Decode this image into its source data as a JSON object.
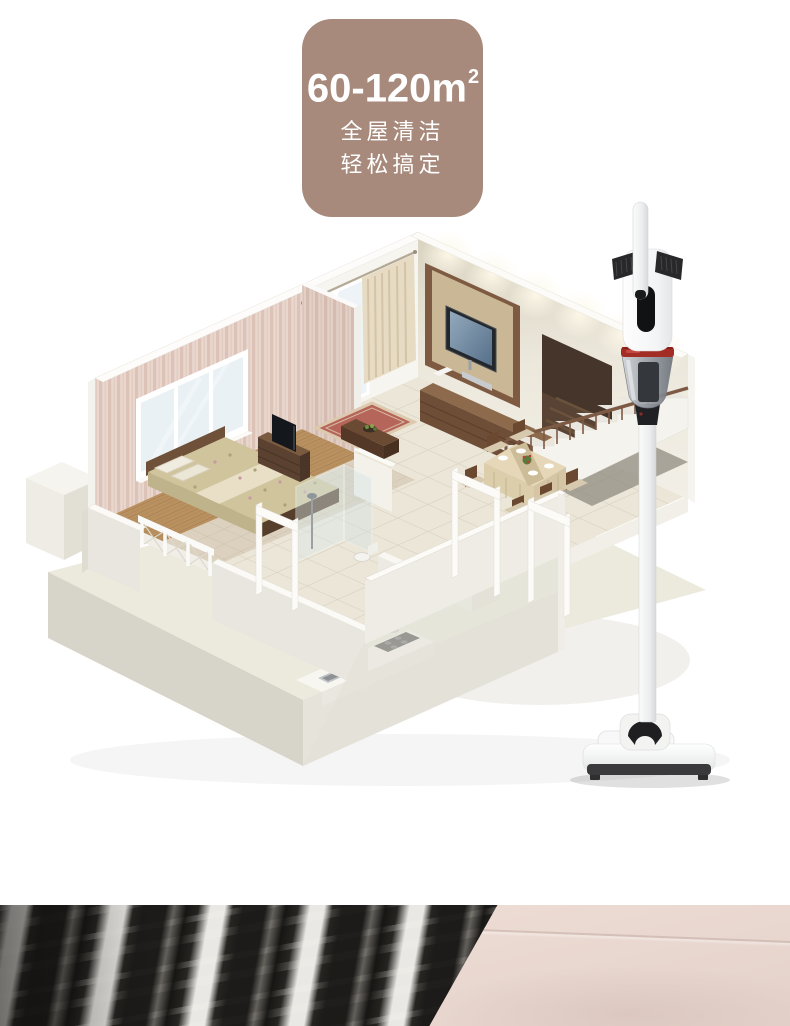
{
  "badge": {
    "area": "60-120m",
    "area_sup": "2",
    "line1": "全屋清洁",
    "line2": "轻松搞定",
    "bg_color": "#a78a7c",
    "text_color": "#ffffff"
  },
  "scene": {
    "type": "isometric-apartment-cutaway",
    "rooms": [
      "bedroom",
      "living-room",
      "dining-area",
      "kitchen",
      "bathroom",
      "balcony",
      "staircase"
    ],
    "palette": {
      "plinth": "#d7d4ca",
      "floor_tile": "#ece6d8",
      "wood_floor": "#b9905f",
      "wallpaper": "#e9d7ce",
      "wall_white": "#f4f2ec",
      "curtain": "#e5d9be",
      "tv_wall_frame": "#7d5a41",
      "stair_rail": "#7d5a43"
    }
  },
  "product": {
    "type": "cordless-stick-vacuum",
    "body_color": "#f7f7f7",
    "accent_ring_color": "#a32c24",
    "dust_cup_color": "#9aa0a7",
    "grip_color": "#28282a"
  },
  "footer": {
    "left_fabric": "dark-plaid-fabric",
    "right_fabric": "beige-plain-fabric",
    "right_color": "#ead9d1"
  }
}
